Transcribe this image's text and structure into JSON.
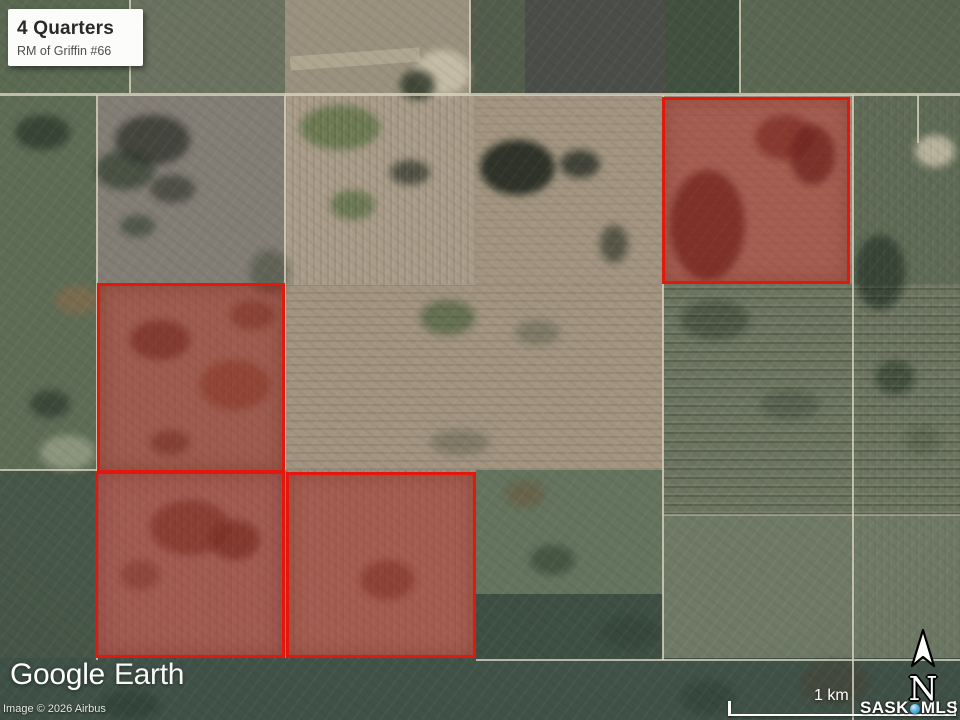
{
  "title_card": {
    "title": "4 Quarters",
    "subtitle": "RM of Griffin #66"
  },
  "branding": {
    "logo_primary": "Google",
    "logo_secondary": "Earth",
    "copyright": "Image © 2026 Airbus"
  },
  "scale_bar": {
    "label": "1 km"
  },
  "watermark": {
    "part1": "SASK",
    "part2": "MLS"
  },
  "compass": {
    "label": "N"
  },
  "map": {
    "type": "satellite-imagery",
    "highlight_outline_color": "#e2180f",
    "highlight_fill_color": "rgba(178,32,26,0.42)",
    "parcels": [
      {
        "id": "quarter-northeast",
        "x": 662,
        "y": 97,
        "w": 188,
        "h": 187
      },
      {
        "id": "quarter-west",
        "x": 97,
        "y": 283,
        "w": 188,
        "h": 190
      },
      {
        "id": "quarter-southwest",
        "x": 95,
        "y": 471,
        "w": 190,
        "h": 187
      },
      {
        "id": "quarter-south",
        "x": 286,
        "y": 472,
        "w": 190,
        "h": 186
      }
    ]
  },
  "colors": {
    "title_card_bg": "#fcfcfa",
    "title_text": "#2a2a2a",
    "subtitle_text": "#4f4f4f",
    "overlay_text": "#ffffff",
    "mls_dot": "#58b7e4"
  }
}
